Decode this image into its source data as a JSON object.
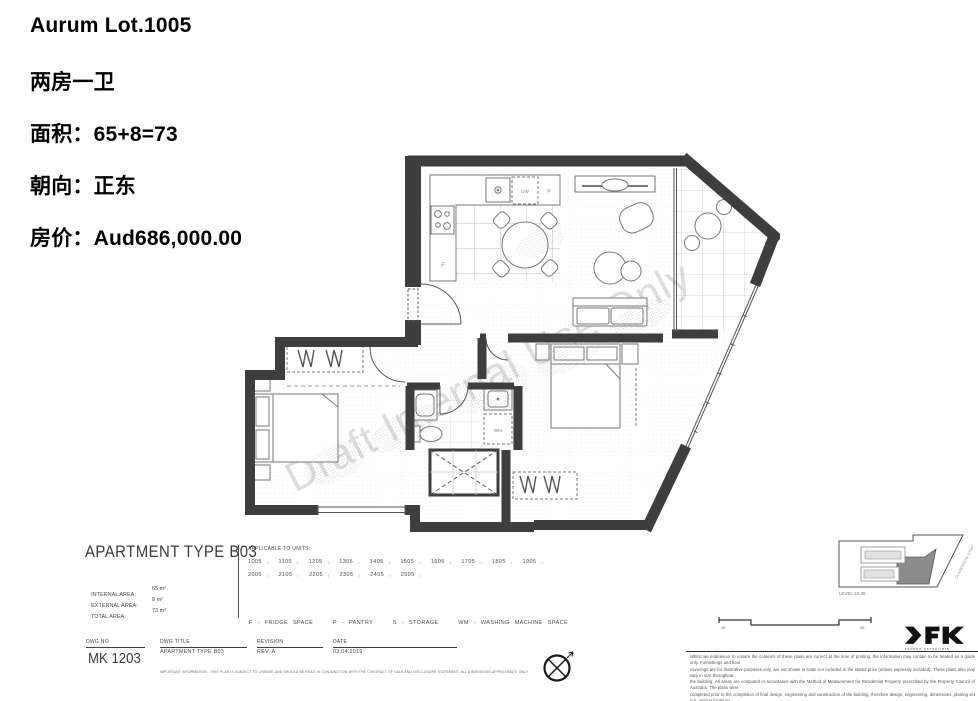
{
  "header": {
    "lot": "Aurum Lot.1005",
    "layout": "两房一卫",
    "area": "面积：65+8=73",
    "orientation": "朝向：正东",
    "price": "房价：Aud686,000.00"
  },
  "plan": {
    "watermark": "Draft Internal Use Only",
    "labels": {
      "fridge": "F",
      "dishwasher": "DW",
      "pantry": "P",
      "washing_machine": "WM"
    }
  },
  "titleblock": {
    "apartment_type": "APARTMENT TYPE B03",
    "areas": [
      {
        "label": "INTERNAL AREA:",
        "value": "65 m²"
      },
      {
        "label": "EXTERNAL AREA:",
        "value": "8 m²"
      },
      {
        "label": "TOTAL AREA:",
        "value": "73 m²"
      }
    ],
    "applicable_title": "APPLICABLE TO UNITS:",
    "units_line1": "1005 ,  1105 ,  1205 ,  1305 ,  1405 ,  1505 ,  1605 ,  1705 ,  1805 ,  1905 ,",
    "units_line2": "2005 ,  2105 ,  2205 ,  2305 ,  2405 ,  2505 ,",
    "legend": "F - FRIDGE SPACE    P - PANTRY    S - STORAGE    WM - WASHING MACHINE SPACE",
    "columns": [
      {
        "label": "DWG NO",
        "value": "MK 1203"
      },
      {
        "label": "DWG TITLE",
        "value": "APARTMENT TYPE B03"
      },
      {
        "label": "REVISION",
        "value": "REV. A"
      },
      {
        "label": "DATE",
        "value": "03.04.2019"
      }
    ],
    "fine_print": "IMPORTANT INFORMATION - THIS PLAN IS SUBJECT TO CHANGE AND SHOULD BE READ IN CONJUNCTION WITH THE CONTRACT OF SALE AND DISCLOSURE STATEMENT. ALL DIMENSIONS APPROXIMATE ONLY.",
    "keyplan": {
      "level": "LEVEL 10-25",
      "street": "CLARENDON STREET"
    },
    "scalebar": {
      "left": "0M",
      "right": "5M"
    }
  },
  "footer": {
    "logo": "FK",
    "logo_sub": "FENDER KATSALIDIS",
    "disclaimer_lines": [
      "Whilst we endeavour to ensure the contents of these plans are correct at the time of printing, the information may contain to be treated as a guide only. Furnishings and floor",
      "coverings are for illustrative purposes only, are not shown to scale nor included in the stated price (unless expressly included). These plans also may vary in size throughout",
      "the building. All areas are computed in accordance with the Method of Measurement for Residential Property prescribed by the Property Council of Australia. The plans were",
      "completed prior to the completion of final design, engineering and construction of the building, therefore design, engineering, dimensions, planing set out, awning locations,",
      "fittings, finishes, and specifications are subject to change without notice in accordance with the provisions of the Contract of Sale."
    ]
  },
  "colors": {
    "wall": "#3e3e3e",
    "fixture": "#777777",
    "grid": "#cccccc",
    "watermark": "#c2c2c2",
    "unit_highlight": "#8c8c8c"
  }
}
